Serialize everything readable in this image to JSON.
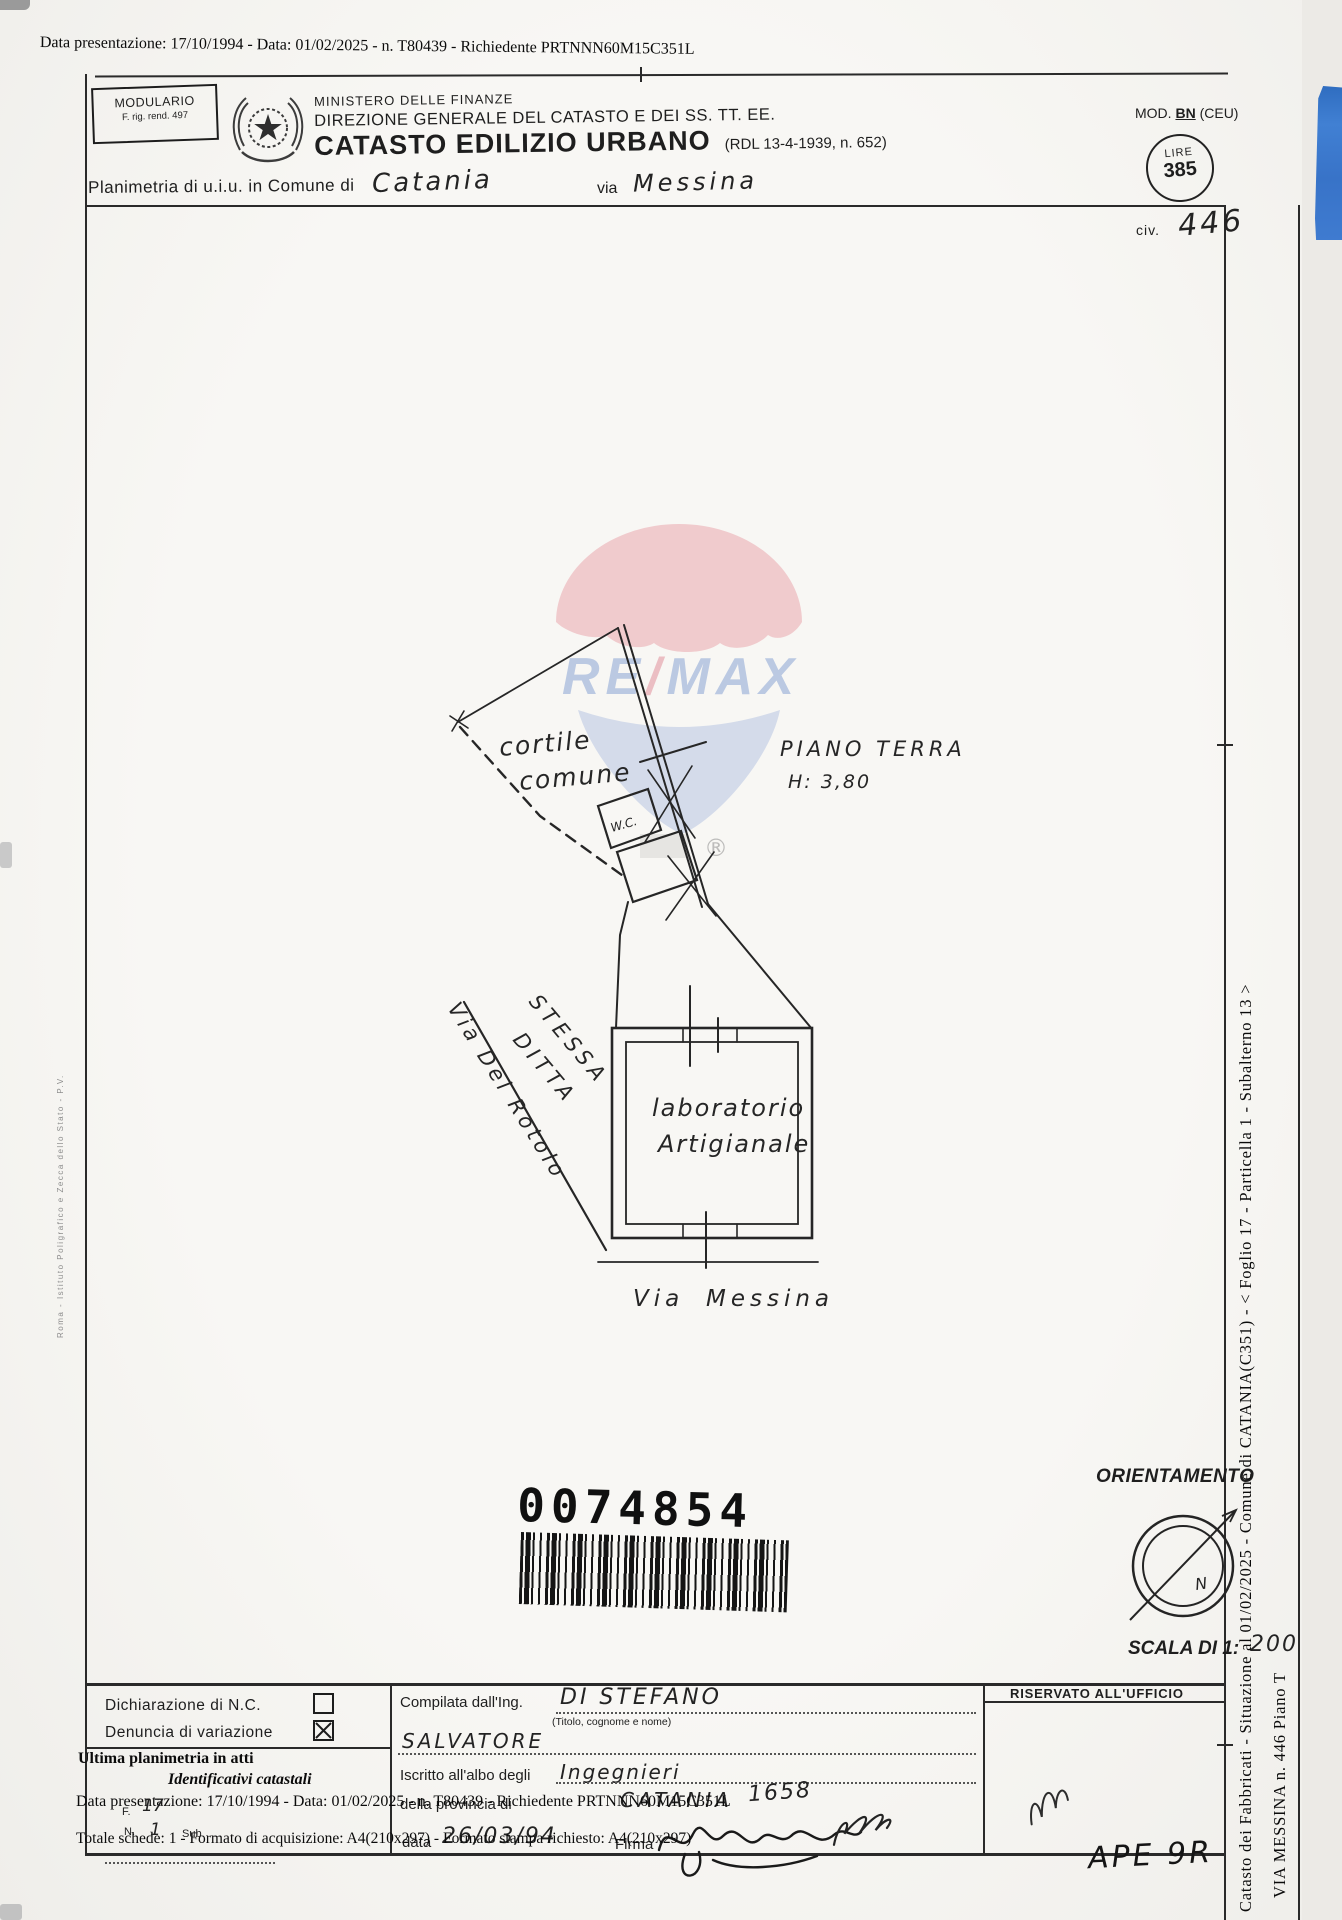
{
  "overlay": {
    "top_line": "Data presentazione: 17/10/1994 - Data: 01/02/2025 - n. T80439 - Richiedente PRTNNN60M15C351L",
    "ultima_planimetria": "Ultima planimetria in atti",
    "identificativi": "Identificativi catastali",
    "data_line": "Data presentazione: 17/10/1994 - Data: 01/02/2025 - n. T80439 - Richiedente PRTNNN60M15C351L",
    "totale_line": "Totale schede: 1 - Formato di acquisizione: A4(210x297) - Formato stampa richiesto: A4(210x297)",
    "foglio_label": "F.",
    "foglio_value": "17",
    "num_label": "N.",
    "num_value": "1",
    "sub_label": "Sub."
  },
  "header": {
    "modulario_line1": "MODULARIO",
    "modulario_line2": "F. rig. rend. 497",
    "ministry": "MINISTERO DELLE FINANZE",
    "direzione": "DIREZIONE GENERALE DEL CATASTO E DEI SS. TT. EE.",
    "catasto": "CATASTO EDILIZIO URBANO",
    "rdl": "(RDL 13-4-1939, n. 652)",
    "mod_pre": "MOD.",
    "mod_bn": "BN",
    "mod_post": "(CEU)",
    "lire_label": "LIRE",
    "lire_value": "385",
    "civ_label": "civ.",
    "civ_value": "446",
    "planimetria_label": "Planimetria di u.i.u. in Comune di",
    "comune_value": "Catania",
    "via_label": "via",
    "via_value": "Messina"
  },
  "plan": {
    "cortile": "cortile",
    "comune": "comune",
    "piano_terra": "PIANO TERRA",
    "altezza": "H: 3,80",
    "wc": "W.C.",
    "laboratorio": "laboratorio",
    "artigianale": "Artigianale",
    "stessa": "STESSA",
    "ditta": "DITTA",
    "via_rotolo": "Via Del Rotolo",
    "via_messina_via": "Via",
    "via_messina_nome": "Messina"
  },
  "watermark": {
    "brand_re": "RE",
    "brand_slash": "/",
    "brand_max": "MAX",
    "registered": "®"
  },
  "barcode": {
    "number": "0074854"
  },
  "orientation": {
    "title": "ORIENTAMENTO",
    "north": "N",
    "scala_label": "SCALA DI 1:",
    "scala_value": "200"
  },
  "sidebar": {
    "line1": "Catasto dei Fabbricati - Situazione al 01/02/2025 - Comune di CATANIA(C351) - < Foglio 17 - Particella 1 - Subalterno 13 >",
    "line2": "VIA MESSINA n. 446 Piano T"
  },
  "form": {
    "dichiarazione": "Dichiarazione di N.C.",
    "denuncia": "Denuncia di variazione",
    "compilata": "Compilata dall'Ing.",
    "compilata_value": "DI STEFANO",
    "titolo_note": "(Titolo, cognome e nome)",
    "nome_value": "SALVATORE",
    "iscritto": "Iscritto all'albo degli",
    "albo_value": "Ingegnieri",
    "provincia": "della provincia di",
    "provincia_value": "CATANIA",
    "numero_value": "1658",
    "data_label": "data",
    "data_value": "26/03/94",
    "firma_label": "Firma",
    "riservato": "RISERVATO ALL'UFFICIO"
  },
  "margin_text": "Roma - Istituto Poligrafico e Zecca dello Stato - P.V.",
  "annotations": {
    "ape": "APE 9R"
  }
}
